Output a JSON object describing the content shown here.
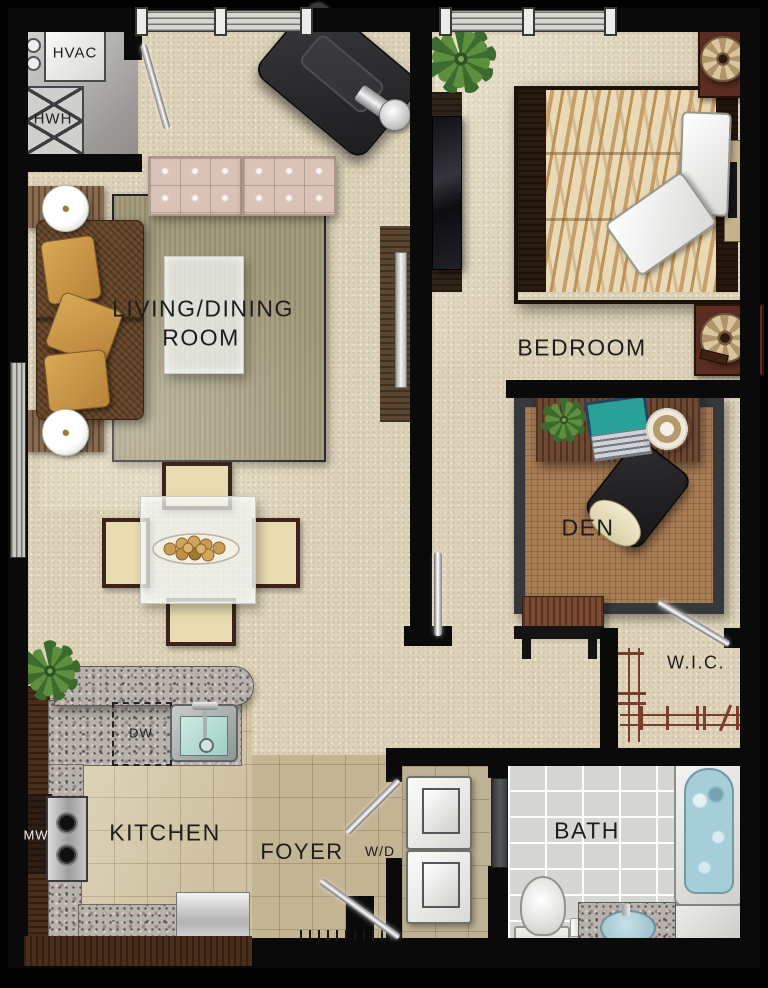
{
  "labels": {
    "hvac": "HVAC",
    "hwh": "HWH",
    "living_line1": "LIVING/DINING",
    "living_line2": "ROOM",
    "bedroom": "BEDROOM",
    "den": "DEN",
    "wic": "W.I.C.",
    "bath": "BATH",
    "kitchen": "KITCHEN",
    "foyer": "FOYER",
    "washer_dryer": "W/D",
    "dishwasher": "DW",
    "microwave": "MW"
  },
  "palette": {
    "wall": "#0a0a0a",
    "carpet": "#ddd2b8",
    "kitchen_tile": "#cfc2a2",
    "bath_tile": "#d6d6d2",
    "granite": "#b7b2ac",
    "wood_dark": "#4a2d1b",
    "rug_living": "#a49b7d",
    "rug_den": "#aa7e55",
    "sofa_brown": "#6d4c2e",
    "bench_pink": "#d9c2b6",
    "zebra_light": "#ead9b6",
    "zebra_dark": "#c79f6a",
    "pillow_gold": "#b9823a",
    "lamp_shade": "#d9c69e",
    "nightstand": "#5a2d20",
    "rod_brown": "#7a3f2b",
    "water": "#a6ced8",
    "plant_green": "#4f7a35"
  }
}
